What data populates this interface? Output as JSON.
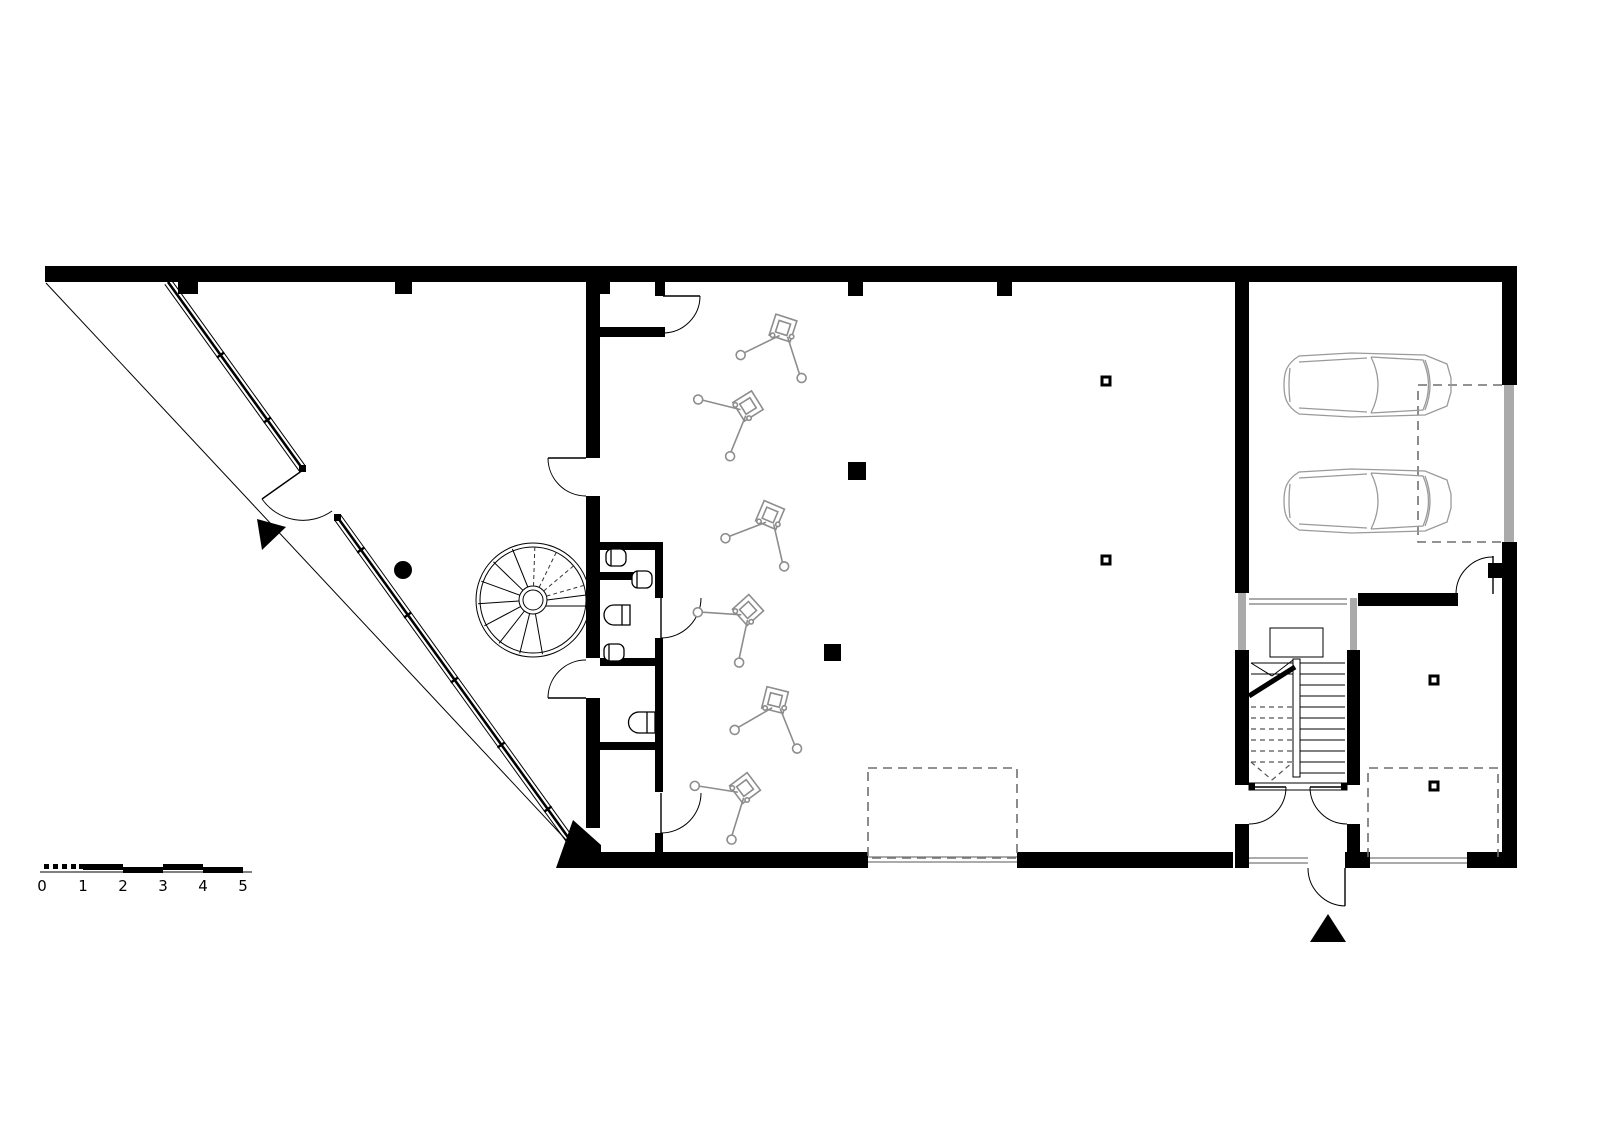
{
  "drawing": {
    "kind": "architectural floor plan",
    "wall_color": "#000000",
    "glazing_color": "#8f8f8f",
    "furniture_color": "#999999",
    "dashed_color": "#6f6f6f",
    "background": "#ffffff"
  },
  "scale_bar": {
    "labels": [
      "0",
      "1",
      "2",
      "3",
      "4",
      "5"
    ]
  },
  "inventory": {
    "cars": 2,
    "easels": 6,
    "toilets": 3,
    "sinks": 2,
    "spiral_stairs": 1,
    "dogleg_stairs": 1,
    "entrance_arrows": 2,
    "filled_columns": 2,
    "hollow_columns": 4,
    "door_swings": 10
  }
}
